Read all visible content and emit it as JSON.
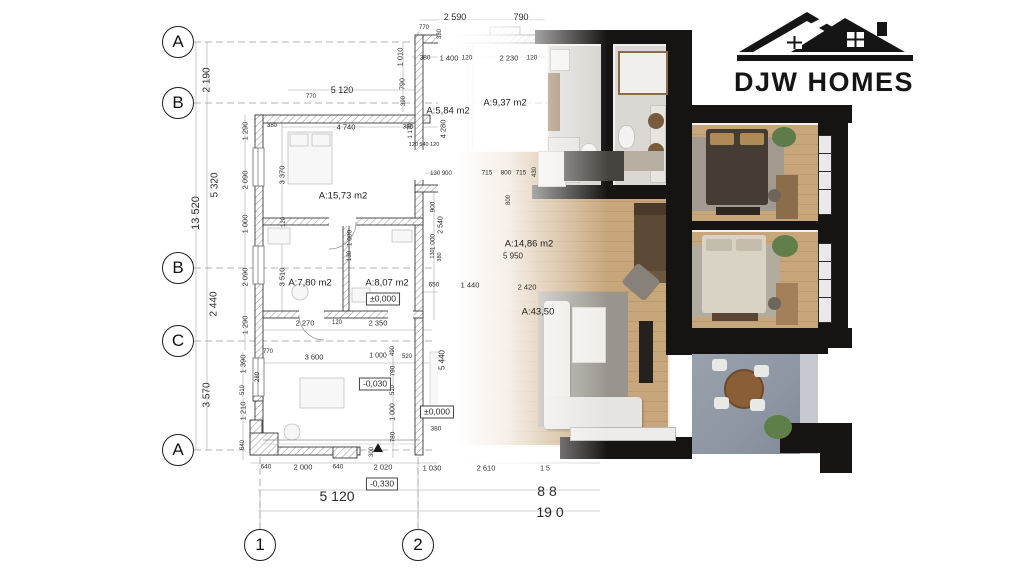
{
  "logo": {
    "brand": "DJW HOMES",
    "ink": "#151515"
  },
  "palette": {
    "wall_black": "#161412",
    "wood_floor": "#c8a67b",
    "tile_floor": "#d8d4d0",
    "terrace_floor": "#8d96a2",
    "rug": "#99958e",
    "bed_dark": "#453c33",
    "bed_light": "#d9d3c6",
    "sofa_white": "#eae8e4",
    "plant_green": "#5e7f4b",
    "cad_line": "#3a3a3a"
  },
  "plan": {
    "grid_row_markers": [
      {
        "label": "A",
        "x": 178,
        "y": 42
      },
      {
        "label": "B",
        "x": 178,
        "y": 103
      },
      {
        "label": "B",
        "x": 178,
        "y": 268
      },
      {
        "label": "C",
        "x": 178,
        "y": 341
      },
      {
        "label": "A",
        "x": 178,
        "y": 450
      }
    ],
    "grid_col_markers": [
      {
        "label": "1",
        "x": 260,
        "y": 545
      },
      {
        "label": "2",
        "x": 418,
        "y": 545
      }
    ],
    "room_labels": [
      {
        "t": "A:15,73 m2",
        "x": 343,
        "y": 196
      },
      {
        "t": "A:7,80 m2",
        "x": 310,
        "y": 283
      },
      {
        "t": "A:8,07 m2",
        "x": 387,
        "y": 283
      },
      {
        "t": "A:5,84 m2",
        "x": 448,
        "y": 111
      },
      {
        "t": "A:9,37 m2",
        "x": 505,
        "y": 103
      },
      {
        "t": "A:14,86 m2",
        "x": 529,
        "y": 244
      },
      {
        "t": "A:43,50",
        "x": 538,
        "y": 312
      }
    ],
    "level_marks": [
      {
        "t": "±0,000",
        "x": 383,
        "y": 299
      },
      {
        "t": "-0,030",
        "x": 375,
        "y": 384
      },
      {
        "t": "±0,000",
        "x": 437,
        "y": 412
      },
      {
        "t": "-0,330",
        "x": 382,
        "y": 484
      }
    ],
    "overall_dimensions": [
      {
        "t": "5 120",
        "x": 337,
        "y": 496,
        "s": 14
      },
      {
        "t": "8 8",
        "x": 547,
        "y": 491,
        "s": 14
      },
      {
        "t": "19 0",
        "x": 550,
        "y": 512,
        "s": 14
      }
    ],
    "dimensions": [
      {
        "t": "2 590",
        "x": 455,
        "y": 17,
        "s": 9
      },
      {
        "t": "790",
        "x": 521,
        "y": 17,
        "s": 9
      },
      {
        "t": "770",
        "x": 424,
        "y": 28,
        "s": 6
      },
      {
        "t": "380",
        "x": 440,
        "y": 34,
        "r": -90,
        "s": 6
      },
      {
        "t": "1 010",
        "x": 400,
        "y": 57,
        "r": -90
      },
      {
        "t": "790",
        "x": 403,
        "y": 84,
        "r": -90,
        "s": 7
      },
      {
        "t": "390",
        "x": 404,
        "y": 101,
        "r": -90,
        "s": 6
      },
      {
        "t": "380",
        "x": 425,
        "y": 58,
        "s": 6.5
      },
      {
        "t": "1 400",
        "x": 449,
        "y": 58
      },
      {
        "t": "120",
        "x": 467,
        "y": 58,
        "s": 6.5
      },
      {
        "t": "2 230",
        "x": 509,
        "y": 58
      },
      {
        "t": "120",
        "x": 532,
        "y": 58,
        "s": 6.5
      },
      {
        "t": "5 120",
        "x": 342,
        "y": 90,
        "s": 9
      },
      {
        "t": "770",
        "x": 311,
        "y": 97,
        "s": 6
      },
      {
        "t": "4 740",
        "x": 346,
        "y": 127
      },
      {
        "t": "380",
        "x": 408,
        "y": 127,
        "s": 6.5
      },
      {
        "t": "120 540 120",
        "x": 424,
        "y": 145,
        "s": 5.5
      },
      {
        "t": "1 170",
        "x": 411,
        "y": 131,
        "r": -90,
        "s": 6
      },
      {
        "t": "4 280",
        "x": 443,
        "y": 129,
        "r": -90
      },
      {
        "t": "130 900",
        "x": 441,
        "y": 174,
        "s": 6
      },
      {
        "t": "715",
        "x": 487,
        "y": 173,
        "s": 6.5
      },
      {
        "t": "800",
        "x": 506,
        "y": 173,
        "s": 6.5
      },
      {
        "t": "715",
        "x": 521,
        "y": 173,
        "s": 6.5
      },
      {
        "t": "430",
        "x": 535,
        "y": 172,
        "r": -90,
        "s": 6
      },
      {
        "t": "800",
        "x": 509,
        "y": 200,
        "r": -90,
        "s": 6
      },
      {
        "t": "2 190",
        "x": 207,
        "y": 80,
        "r": -90,
        "s": 10
      },
      {
        "t": "13 520",
        "x": 196,
        "y": 213,
        "r": -90,
        "s": 11
      },
      {
        "t": "5 320",
        "x": 215,
        "y": 185,
        "r": -90,
        "s": 10
      },
      {
        "t": "2 440",
        "x": 214,
        "y": 304,
        "r": -90,
        "s": 10
      },
      {
        "t": "3 570",
        "x": 207,
        "y": 395,
        "r": -90,
        "s": 10
      },
      {
        "t": "1 290",
        "x": 245,
        "y": 131,
        "r": -90
      },
      {
        "t": "2 090",
        "x": 245,
        "y": 180,
        "r": -90
      },
      {
        "t": "1 000",
        "x": 245,
        "y": 224,
        "r": -90
      },
      {
        "t": "2 090",
        "x": 245,
        "y": 277,
        "r": -90
      },
      {
        "t": "1 290",
        "x": 245,
        "y": 325,
        "r": -90
      },
      {
        "t": "380",
        "x": 272,
        "y": 126,
        "s": 6
      },
      {
        "t": "3 370",
        "x": 282,
        "y": 175,
        "r": -90
      },
      {
        "t": "120",
        "x": 284,
        "y": 222,
        "r": -90,
        "s": 6
      },
      {
        "t": "3 510",
        "x": 282,
        "y": 277,
        "r": -90
      },
      {
        "t": "1 000",
        "x": 350,
        "y": 238,
        "r": -90,
        "s": 6.5
      },
      {
        "t": "130",
        "x": 350,
        "y": 256,
        "r": -90,
        "s": 6
      },
      {
        "t": "900",
        "x": 433,
        "y": 207,
        "r": -90,
        "s": 6.5
      },
      {
        "t": "2 540",
        "x": 441,
        "y": 225,
        "r": -90,
        "s": 7
      },
      {
        "t": "1 000",
        "x": 433,
        "y": 242,
        "r": -90,
        "s": 6.5
      },
      {
        "t": "130",
        "x": 433,
        "y": 254,
        "r": -90,
        "s": 5.5
      },
      {
        "t": "380",
        "x": 440,
        "y": 257,
        "r": -90,
        "s": 5.5
      },
      {
        "t": "5 950",
        "x": 513,
        "y": 256,
        "s": 8
      },
      {
        "t": "650",
        "x": 434,
        "y": 285,
        "s": 6.5
      },
      {
        "t": "1 440",
        "x": 470,
        "y": 285
      },
      {
        "t": "2 420",
        "x": 527,
        "y": 287
      },
      {
        "t": "2 270",
        "x": 305,
        "y": 323
      },
      {
        "t": "120",
        "x": 337,
        "y": 323,
        "s": 6
      },
      {
        "t": "2 350",
        "x": 378,
        "y": 323
      },
      {
        "t": "3 600",
        "x": 314,
        "y": 357
      },
      {
        "t": "1 000",
        "x": 378,
        "y": 356,
        "s": 7
      },
      {
        "t": "520",
        "x": 407,
        "y": 357,
        "s": 6
      },
      {
        "t": "5 440",
        "x": 442,
        "y": 360,
        "r": -90,
        "s": 8
      },
      {
        "t": "490",
        "x": 393,
        "y": 351,
        "r": -90,
        "s": 6
      },
      {
        "t": "790",
        "x": 393,
        "y": 371,
        "r": -90,
        "s": 6.5
      },
      {
        "t": "510",
        "x": 393,
        "y": 390,
        "r": -90,
        "s": 6
      },
      {
        "t": "1 000",
        "x": 393,
        "y": 412,
        "r": -90,
        "s": 7
      },
      {
        "t": "780",
        "x": 393,
        "y": 437,
        "r": -90,
        "s": 6.5
      },
      {
        "t": "300",
        "x": 372,
        "y": 452,
        "r": -90,
        "s": 6
      },
      {
        "t": "1 390",
        "x": 243,
        "y": 364,
        "r": -90
      },
      {
        "t": "510",
        "x": 243,
        "y": 390,
        "r": -90,
        "s": 6
      },
      {
        "t": "1 210",
        "x": 243,
        "y": 411,
        "r": -90
      },
      {
        "t": "640",
        "x": 243,
        "y": 445,
        "r": -90,
        "s": 6
      },
      {
        "t": "770",
        "x": 268,
        "y": 352,
        "s": 6
      },
      {
        "t": "280",
        "x": 258,
        "y": 377,
        "r": -90,
        "s": 6
      },
      {
        "t": "380",
        "x": 436,
        "y": 429,
        "s": 6.5
      },
      {
        "t": "640",
        "x": 266,
        "y": 467,
        "s": 6.5
      },
      {
        "t": "2 000",
        "x": 303,
        "y": 467
      },
      {
        "t": "640",
        "x": 338,
        "y": 467,
        "s": 6.5
      },
      {
        "t": "2 020",
        "x": 383,
        "y": 467
      },
      {
        "t": "1 030",
        "x": 432,
        "y": 468
      },
      {
        "t": "2 610",
        "x": 486,
        "y": 468
      },
      {
        "t": "1 5",
        "x": 545,
        "y": 469,
        "s": 7
      }
    ]
  }
}
